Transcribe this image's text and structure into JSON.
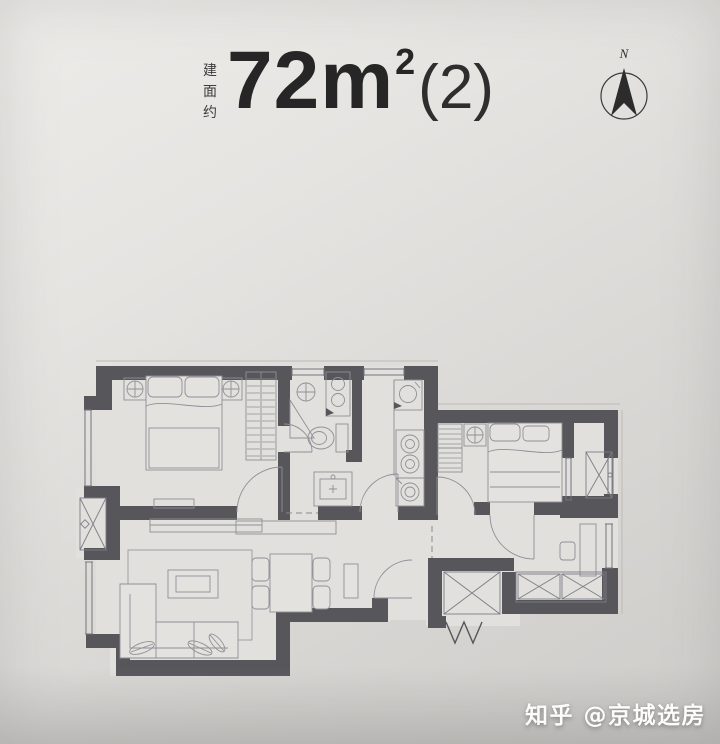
{
  "page": {
    "background_top_left": "#eeece9",
    "background_bottom_right": "#ceccc9"
  },
  "header": {
    "area_prefix_vertical": "建面约",
    "area_number": "72",
    "area_unit": "m",
    "area_sup": "2",
    "area_suffix": "(2)"
  },
  "compass": {
    "north_label": "N"
  },
  "floorplan": {
    "wall_color": "#57565A",
    "floor_color": "#e2e0dd",
    "furniture_line_color": "#8f8f96",
    "window_line_color": "#74747b",
    "closet_hatch_color": "#7d7d84"
  },
  "watermark": {
    "text": "知乎 @京城选房"
  }
}
